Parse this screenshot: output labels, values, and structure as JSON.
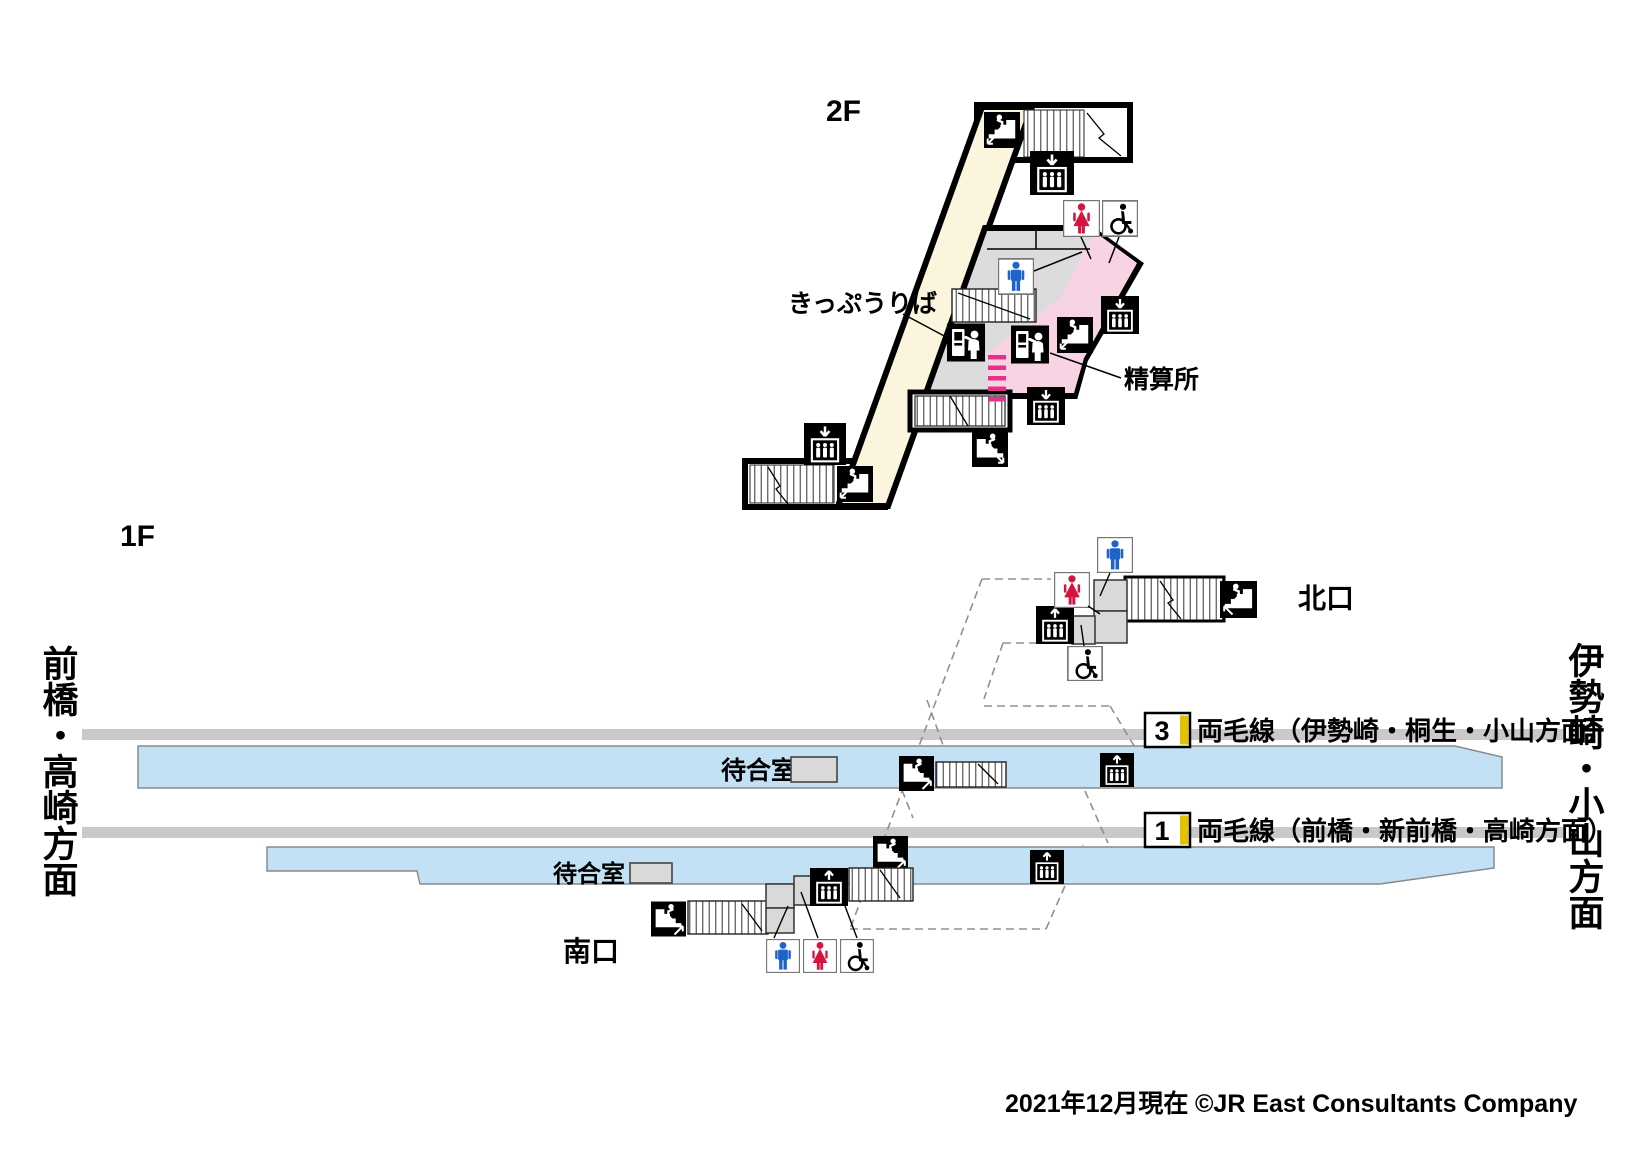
{
  "floor2": {
    "label": "2F",
    "ticket_office": "きっぷうりば",
    "fare_adjustment": "精算所"
  },
  "floor1": {
    "label": "1F",
    "north_exit": "北口",
    "south_exit": "南口",
    "waiting_room_north": "待合室",
    "waiting_room_south": "待合室",
    "direction_left": "前橋・高崎方面",
    "direction_right": "伊勢崎・小山方面",
    "platforms": [
      {
        "number": "3",
        "line": "両毛線（伊勢崎・桐生・小山方面）"
      },
      {
        "number": "1",
        "line": "両毛線（前橋・新前橋・高崎方面）"
      }
    ]
  },
  "footer": {
    "as_of": "2021年12月現在",
    "copyright": "©JR East Consultants Company"
  },
  "icons": {
    "stairs-icon": "black square, white staircase with walking person and direction arrow",
    "elevator-up-icon": "black square, white up arrow over elevator cab with 3 people",
    "elevator-down-icon": "black square, white down arrow over elevator cab with 3 people",
    "mens-toilet-icon": "white box with blue standing man pictogram",
    "womens-toilet-icon": "white box with red woman pictogram",
    "wheelchair-icon": "white box with black wheelchair pictogram",
    "ticket-machine-icon": "black square, white ticket vending machine with person"
  },
  "colors": {
    "concourse_yellow": "#FAF5DC",
    "hall_gray": "#DCDCDC",
    "fare_gate_pink": "#F8D3E3",
    "gate_stripe_magenta": "#E8308A",
    "platform_blue": "#C3E1F5",
    "track_gray": "#C9C9C9",
    "platform_number_stripe_yellow": "#E3C000",
    "mens_blue": "#1E64C8",
    "womens_red": "#D7133F"
  }
}
